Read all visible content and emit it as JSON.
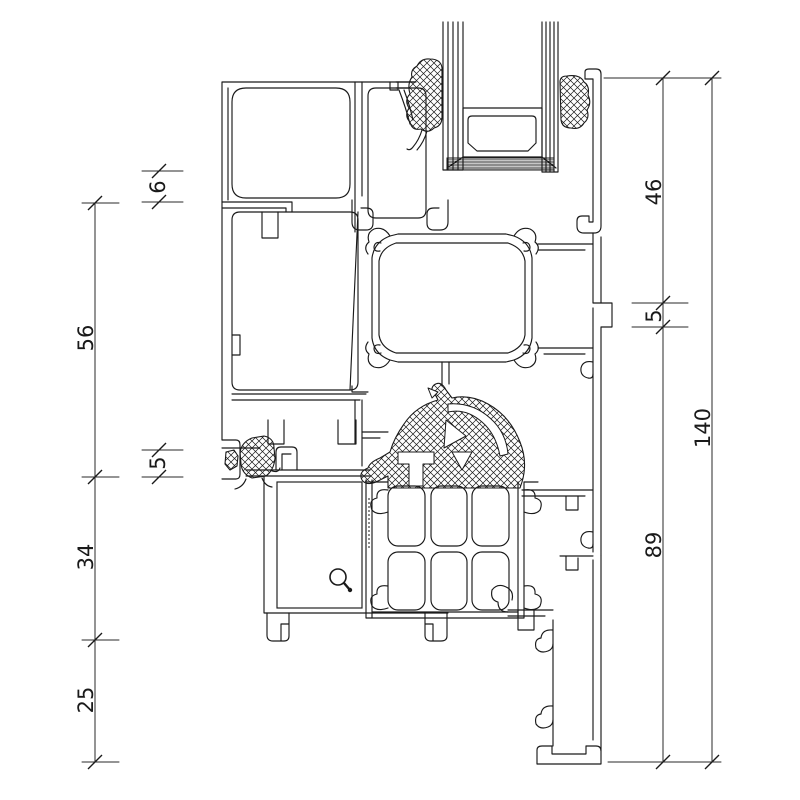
{
  "colors": {
    "background": "#ffffff",
    "line": "#1a1a1a",
    "dimension_line": "#2a2a2a"
  },
  "dimensions": {
    "left": [
      {
        "label": "6"
      },
      {
        "label": "56"
      },
      {
        "label": "5"
      },
      {
        "label": "34"
      },
      {
        "label": "25"
      }
    ],
    "right": [
      {
        "label": "46"
      },
      {
        "label": "5"
      },
      {
        "label": "89"
      },
      {
        "label": "140"
      }
    ]
  },
  "icons": [
    {
      "name": "magnifier-cursor-icon"
    }
  ]
}
